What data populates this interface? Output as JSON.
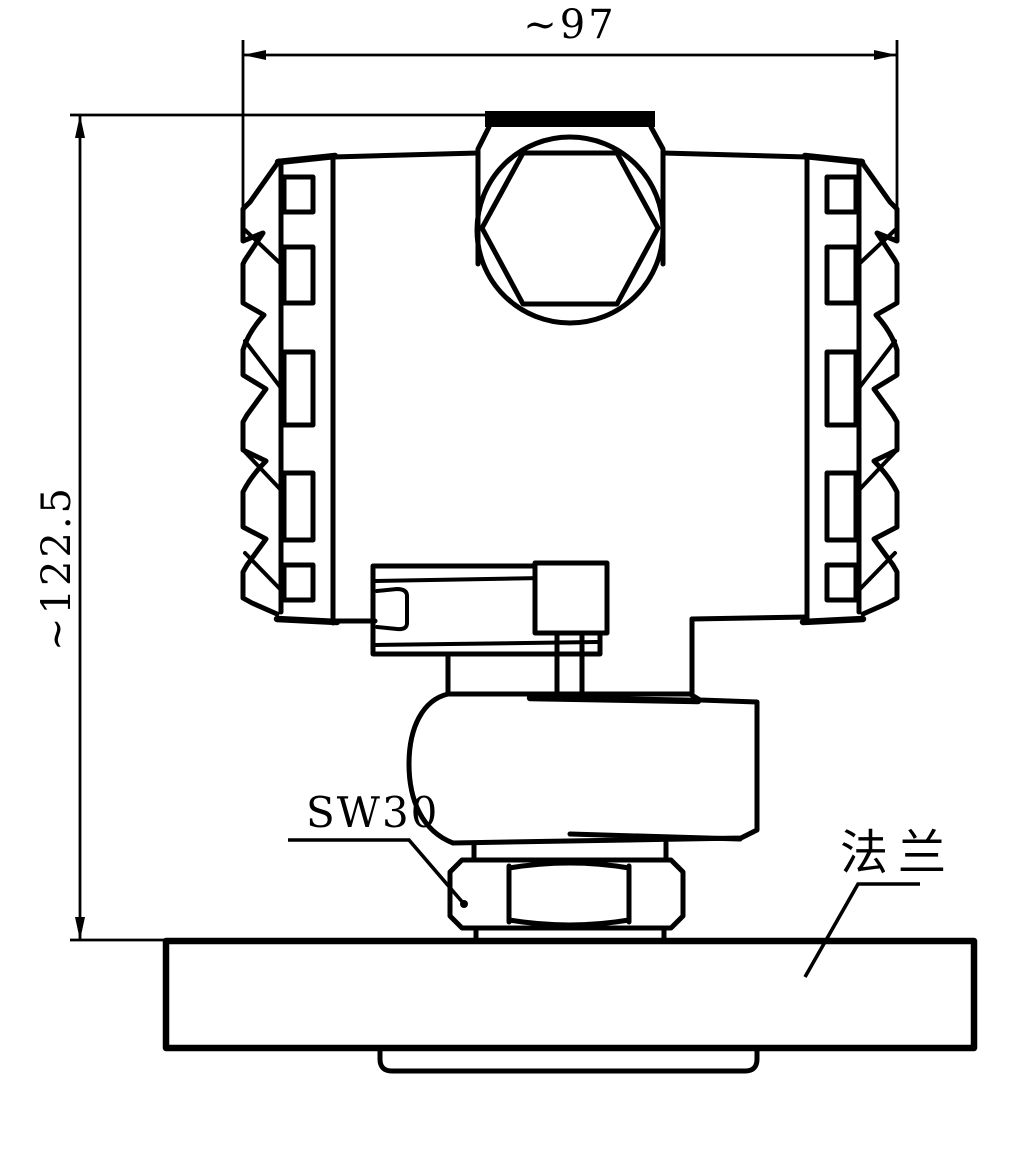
{
  "drawing": {
    "background_color": "#ffffff",
    "line_color": "#000000",
    "labels": {
      "width_dim": "~97",
      "height_dim": "~122.5",
      "wrench_size": "SW30",
      "flange": "法兰"
    },
    "parts": [
      "hex-vent-plug",
      "ribbed-cover-left",
      "ribbed-cover-right",
      "transmitter-housing",
      "display-module",
      "process-connection",
      "hex-nut",
      "washer-neck",
      "mounting-flange",
      "flange-boss"
    ]
  }
}
